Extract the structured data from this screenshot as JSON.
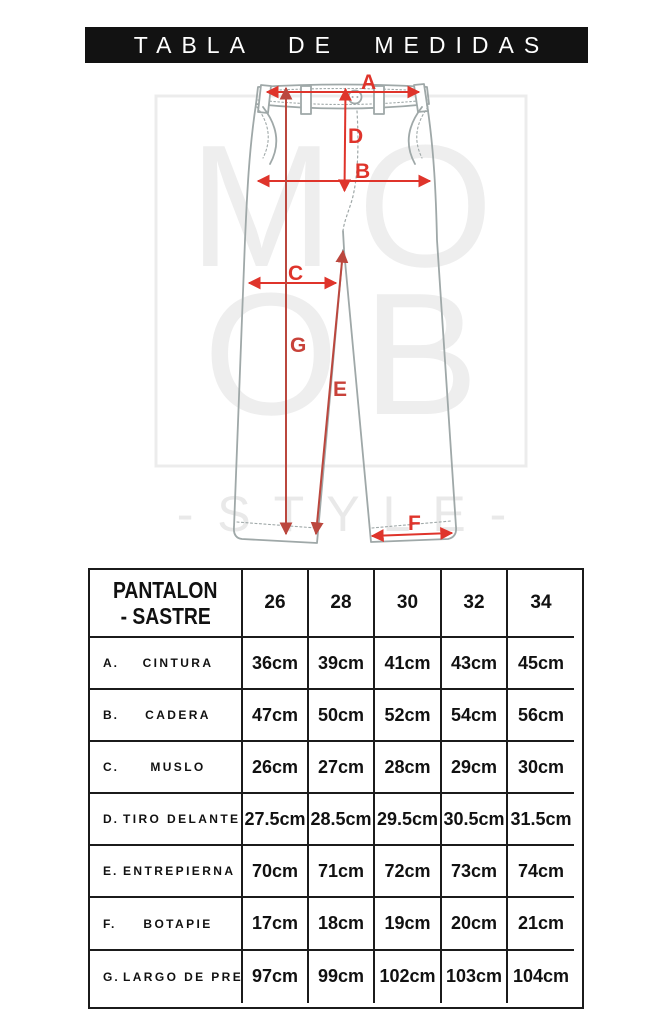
{
  "header": {
    "title": "TABLA DE MEDIDAS"
  },
  "watermark": {
    "line1": "MO",
    "line2": "OB",
    "line3": "- S T Y L E -"
  },
  "diagram": {
    "labels": {
      "a": "A",
      "b": "B",
      "c": "C",
      "d": "D",
      "e": "E",
      "f": "F",
      "g": "G"
    }
  },
  "table": {
    "product": {
      "line1": "PANTALON",
      "line2": "- SASTRE"
    },
    "sizes": [
      "26",
      "28",
      "30",
      "32",
      "34"
    ],
    "rows": [
      {
        "letter": "A.",
        "name": "CINTURA",
        "values": [
          "36cm",
          "39cm",
          "41cm",
          "43cm",
          "45cm"
        ]
      },
      {
        "letter": "B.",
        "name": "CADERA",
        "values": [
          "47cm",
          "50cm",
          "52cm",
          "54cm",
          "56cm"
        ]
      },
      {
        "letter": "C.",
        "name": "MUSLO",
        "values": [
          "26cm",
          "27cm",
          "28cm",
          "29cm",
          "30cm"
        ]
      },
      {
        "letter": "D.",
        "name": "TIRO DELANTERO",
        "values": [
          "27.5cm",
          "28.5cm",
          "29.5cm",
          "30.5cm",
          "31.5cm"
        ]
      },
      {
        "letter": "E.",
        "name": "ENTREPIERNA",
        "values": [
          "70cm",
          "71cm",
          "72cm",
          "73cm",
          "74cm"
        ]
      },
      {
        "letter": "F.",
        "name": "BOTAPIE",
        "values": [
          "17cm",
          "18cm",
          "19cm",
          "20cm",
          "21cm"
        ]
      },
      {
        "letter": "G.",
        "name": "LARGO DE PRENDA",
        "values": [
          "97cm",
          "99cm",
          "102cm",
          "103cm",
          "104cm"
        ]
      }
    ]
  },
  "colors": {
    "accent_red": "#df342b",
    "dim_dark_red": "#bb473e",
    "outline_gray": "#9fa8a8",
    "watermark_gray": "#ededed",
    "bar_black": "#121212",
    "table_border": "#1b1b1b"
  }
}
